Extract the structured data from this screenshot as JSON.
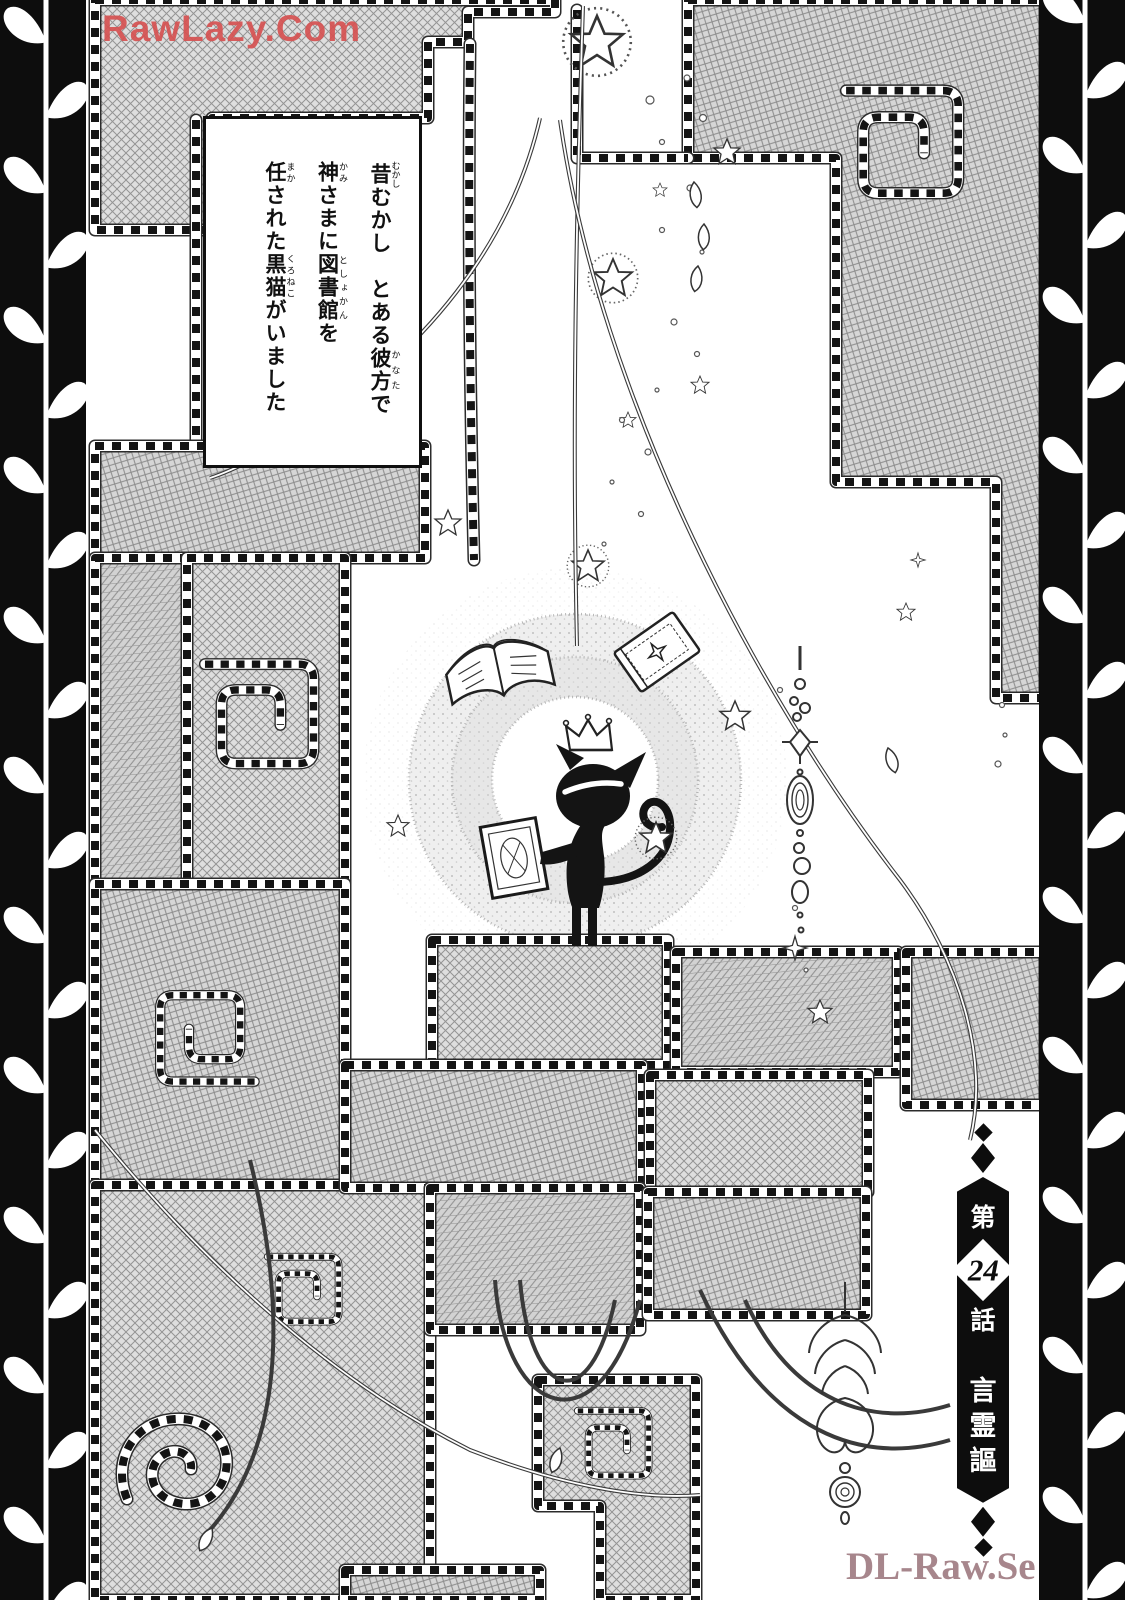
{
  "page": {
    "width": 1125,
    "height": 1600,
    "background": "#ffffff",
    "type": "manga-chapter-title-page"
  },
  "watermarks": {
    "top": {
      "text": "RawLazy.Com",
      "color": "#d65252"
    },
    "bottom": {
      "text": "DL-Raw.Se",
      "color": "#a7868c"
    }
  },
  "narration": {
    "lines": [
      {
        "segments": [
          {
            "t": "昔",
            "r": "むかし"
          },
          {
            "t": "むかし　とある"
          },
          {
            "t": "彼方",
            "r": "かなた"
          },
          {
            "t": "で"
          }
        ]
      },
      {
        "segments": [
          {
            "t": "神",
            "r": "かみ"
          },
          {
            "t": "さまに"
          },
          {
            "t": "図書館",
            "r": "としょかん"
          },
          {
            "t": "を"
          }
        ]
      },
      {
        "segments": [
          {
            "t": "任",
            "r": "まか"
          },
          {
            "t": "された"
          },
          {
            "t": "黒猫",
            "r": "くろねこ"
          },
          {
            "t": "がいました"
          }
        ]
      }
    ]
  },
  "chapter_banner": {
    "prefix": "第",
    "number": "24",
    "suffix": "話",
    "title": "言霊謳",
    "title_chars": [
      "言",
      "霊",
      "謳"
    ],
    "banner_color": "#0d0d0d",
    "text_color": "#ffffff"
  },
  "illustration": {
    "elements": [
      "black-cat-silhouette",
      "crown",
      "open-book",
      "closed-book",
      "held-book",
      "magic-circle-rings",
      "star-bursts",
      "sparkle-dots",
      "patchwork-quilt",
      "stitched-seams",
      "square-spiral-motifs",
      "hanging-vines",
      "bead-ornament-chain",
      "chandelier-ornament",
      "leaf-vine-side-borders"
    ],
    "colors": {
      "ink": "#141414",
      "patch_fill": "#dcdcdc",
      "stitch": "#141414",
      "border_bg": "#0d0d0d"
    }
  }
}
